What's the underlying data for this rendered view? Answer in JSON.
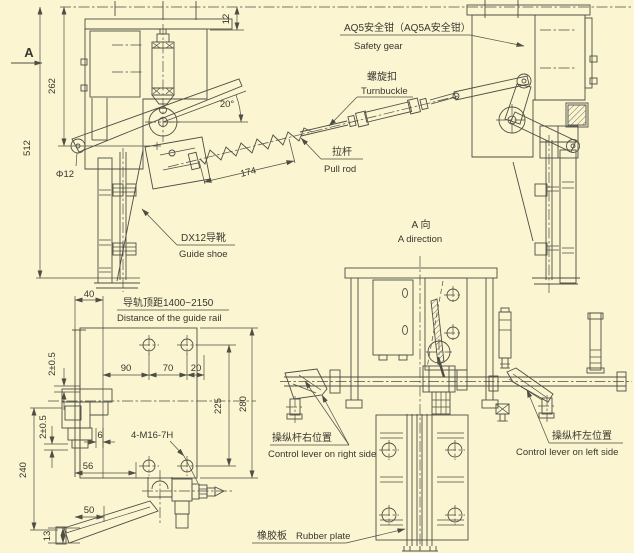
{
  "drawing": {
    "background": "#fbf5d1",
    "ink": "#4e4e45"
  },
  "labels": {
    "view_arrow": "A",
    "safety_gear_zh": "AQ5安全钳（AQ5A安全钳）",
    "safety_gear_en": "Safety gear",
    "turnbuckle_zh": "螺旋扣",
    "turnbuckle_en": "Turnbuckle",
    "pull_rod_zh": "拉杆",
    "pull_rod_en": "Pull rod",
    "guide_shoe_zh": "DX12导靴",
    "guide_shoe_en": "Guide shoe",
    "a_direction_zh": "A 向",
    "a_direction_en": "A direction",
    "rail_distance_zh": "导轨顶距1400~2150",
    "rail_distance_en": "Distance of the guide rail",
    "lever_right_zh": "操纵杆右位置",
    "lever_right_en": "Control lever on right side",
    "lever_left_zh": "操纵杆左位置",
    "lever_left_en": "Control lever on left side",
    "rubber_plate_zh": "橡胶板",
    "rubber_plate_en": "Rubber plate",
    "thread_spec": "4-M16-7H"
  },
  "dimensions": {
    "overall_height": "512",
    "upper_height": "262",
    "top_clearance": "12",
    "pin_diameter": "Φ12",
    "lever_angle": "20°",
    "spring_length": "174",
    "plate_offset": "40",
    "hole_pitch_90": "90",
    "hole_pitch_70": "70",
    "hole_edge_20": "20",
    "hole_row_span": "225",
    "plate_height": "280",
    "gap_upper": "2±0.5",
    "gap_lower": "2±0.5",
    "step_width": "6",
    "edge_distance": "56",
    "bracket_height": "240",
    "lever_offset": "50",
    "lever_end_height": "13"
  }
}
